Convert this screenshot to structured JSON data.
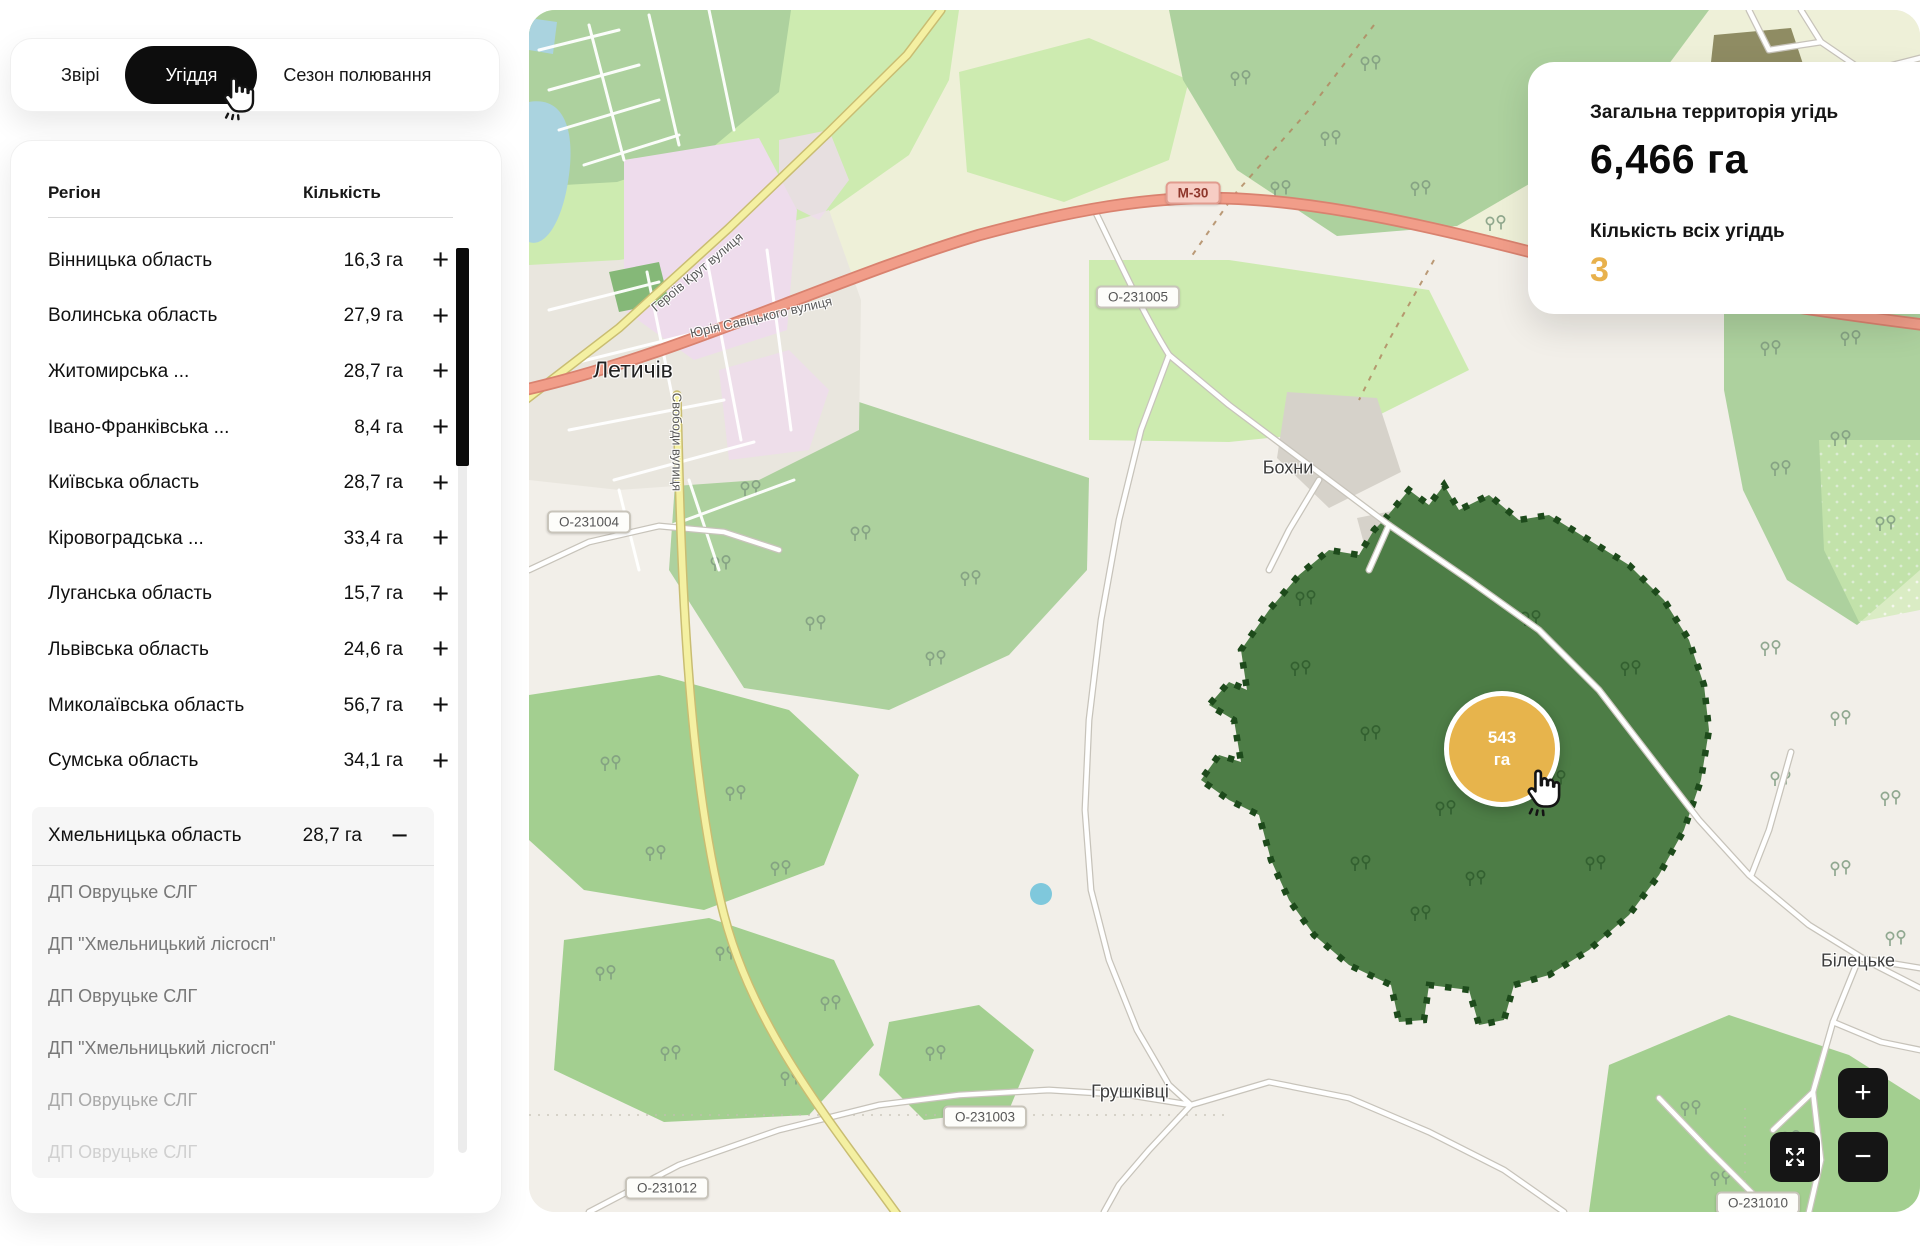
{
  "sidebar": {
    "tabs": [
      {
        "label": "Звірі"
      },
      {
        "label": "Угіддя"
      },
      {
        "label": "Сезон полювання"
      }
    ],
    "active_tab": "Угіддя",
    "table": {
      "columns": {
        "region": "Регіон",
        "count": "Кількість"
      },
      "expand_icon": "+",
      "collapse_icon": "−",
      "rows": [
        {
          "name": "Вінницька область",
          "value": "16,3 га"
        },
        {
          "name": "Волинська область",
          "value": "27,9 га"
        },
        {
          "name": "Житомирська ...",
          "value": "28,7 га"
        },
        {
          "name": "Івано-Франківська ...",
          "value": "8,4 га"
        },
        {
          "name": "Київська область",
          "value": "28,7 га"
        },
        {
          "name": "Кіровоградська ...",
          "value": "33,4 га"
        },
        {
          "name": "Луганська область",
          "value": "15,7 га"
        },
        {
          "name": "Львівська область",
          "value": "24,6 га"
        },
        {
          "name": "Миколаївська область",
          "value": "56,7 га"
        },
        {
          "name": "Сумська область",
          "value": "34,1 га"
        }
      ],
      "expanded_row": {
        "name": "Хмельницька область",
        "value": "28,7 га"
      },
      "expanded_children": [
        "ДП Овруцьке СЛГ",
        "ДП \"Хмельницький лісгосп\"",
        "ДП Овруцьке СЛГ",
        "ДП \"Хмельницький лісгосп\"",
        "ДП Овруцьке СЛГ",
        "ДП Овруцьке СЛГ"
      ]
    }
  },
  "summary_card": {
    "total_label": "Загальна территорія угідь",
    "total_value": "6,466 га",
    "count_label": "Кількість всіх угіддь",
    "count_value": "3",
    "accent_color": "#E8B14C"
  },
  "map": {
    "marker": {
      "value": "543",
      "unit": "га",
      "color": "#E7B44C"
    },
    "places": [
      "Летичів",
      "Бохни",
      "Грушківці",
      "Білецьке"
    ],
    "shields": [
      "М-30",
      "О-231005",
      "О-231004",
      "О-231003",
      "О-231012",
      "О-231010"
    ],
    "streets": [
      "Героїв Крут вулиця",
      "Юрія Савіцького вулиця",
      "Свободи вулиця"
    ],
    "controls": {
      "zoom_in": "+",
      "zoom_out": "−"
    }
  }
}
